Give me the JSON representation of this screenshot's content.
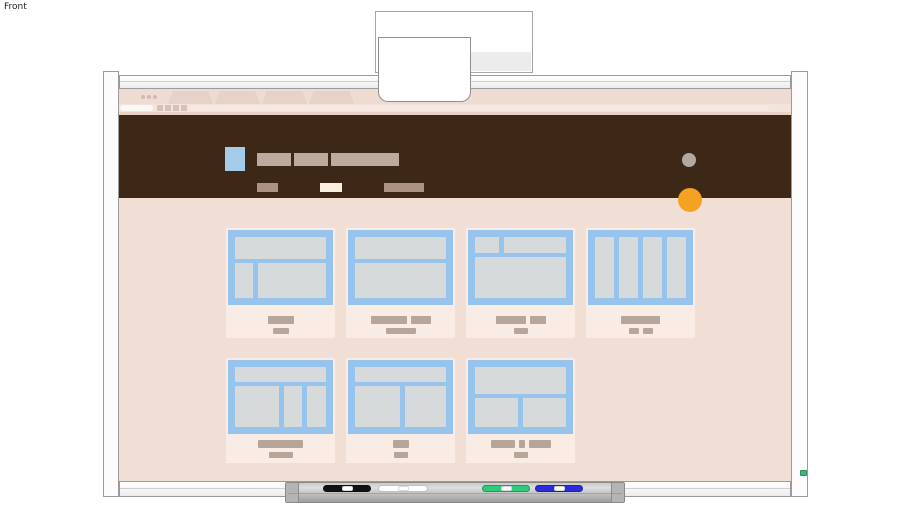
{
  "view_label": "Front",
  "colors": {
    "page_bg": "#f1dfd6",
    "chrome_bg": "#eedcd3",
    "chrome_url_bg": "#f3e4db",
    "chrome_divider": "#e9d3c9",
    "chrome_dot": "#d2b9af",
    "tab": "#e6d2c9",
    "url_white": "#fbf7f4",
    "url_square": "#d8c0b6",
    "url_bar": "#f7e9e1",
    "header_brown": "#3d2817",
    "logo_blue": "#a5cbe9",
    "nav_bar": "#bdaa9d",
    "subnav_bar": "#ab9282",
    "subnav_active": "#f7efdf",
    "avatar_gray": "#b3a9a3",
    "accent_orange": "#f4a124",
    "card_bg": "#f8ece5",
    "thumb_blue": "#97c4ec",
    "thumb_block": "#d7dada",
    "caption_bar": "#b7a59a",
    "frame_white": "#fcfcfc",
    "frame_border": "#9b9b9b",
    "led_green": "#3cb878",
    "projector_white": "#ffffff",
    "projector_gray": "#ececec",
    "pen_black": "#111111",
    "pen_white": "#ffffff",
    "pen_green": "#2ecc7a",
    "pen_blue": "#2c2cdb"
  },
  "browser": {
    "traffic_dots": 3,
    "tabs": 4,
    "toolbar_squares": 4
  },
  "site": {
    "logo": "blue-square-logo",
    "nav_bars": [
      34,
      34,
      68
    ],
    "subnav": [
      {
        "w": 21,
        "active": false
      },
      {
        "w": 22,
        "active": true
      },
      {
        "w": 40,
        "active": false
      }
    ],
    "avatar": "user-avatar-circle",
    "badge": "orange-notification-circle"
  },
  "cards": {
    "row1": [
      {
        "layout": "header-sidebar-content",
        "thumb": [
          {
            "h": 21,
            "cols": [
              100
            ]
          },
          {
            "h": 34,
            "cols": [
              21,
              79
            ]
          }
        ],
        "caption": [
          [
            26
          ],
          [
            16
          ]
        ]
      },
      {
        "layout": "header-hero",
        "thumb": [
          {
            "h": 21,
            "cols": [
              100
            ]
          },
          {
            "h": 34,
            "cols": [
              100
            ]
          }
        ],
        "caption": [
          [
            36,
            20
          ],
          [
            30
          ]
        ]
      },
      {
        "layout": "toolbar-hero",
        "thumb": [
          {
            "h": 15,
            "cols": [
              28,
              72
            ]
          },
          {
            "h": 38,
            "cols": [
              100
            ]
          }
        ],
        "caption": [
          [
            30,
            16
          ],
          [
            14
          ]
        ]
      },
      {
        "layout": "four-columns",
        "thumb": [
          {
            "h": 59,
            "cols": [
              25,
              25,
              25,
              25
            ]
          }
        ],
        "caption": [
          [
            39
          ],
          [
            10,
            10
          ]
        ]
      }
    ],
    "row2": [
      {
        "layout": "header-three-columns",
        "thumb": [
          {
            "h": 14,
            "cols": [
              100
            ]
          },
          {
            "h": 38,
            "cols": [
              50,
              21,
              22
            ]
          }
        ],
        "caption": [
          [
            45
          ],
          [
            24
          ]
        ]
      },
      {
        "layout": "header-two-columns",
        "thumb": [
          {
            "h": 14,
            "cols": [
              100
            ]
          },
          {
            "h": 38,
            "cols": [
              52,
              48
            ]
          }
        ],
        "caption": [
          [
            16
          ],
          [
            14
          ]
        ]
      },
      {
        "layout": "hero-two-blocks",
        "thumb": [
          {
            "h": 27,
            "cols": [
              100
            ]
          },
          {
            "h": 28,
            "cols": [
              50,
              50
            ]
          }
        ],
        "caption": [
          [
            24,
            6,
            22
          ],
          [
            14
          ]
        ]
      }
    ]
  },
  "tray": {
    "pens": [
      {
        "name": "black-pen",
        "color": "#111111"
      },
      {
        "name": "eraser",
        "color": "#ffffff"
      },
      {
        "name": "green-pen",
        "color": "#2ecc7a"
      },
      {
        "name": "blue-pen",
        "color": "#2c2cdb"
      }
    ]
  },
  "board": {
    "led": "power-led"
  }
}
